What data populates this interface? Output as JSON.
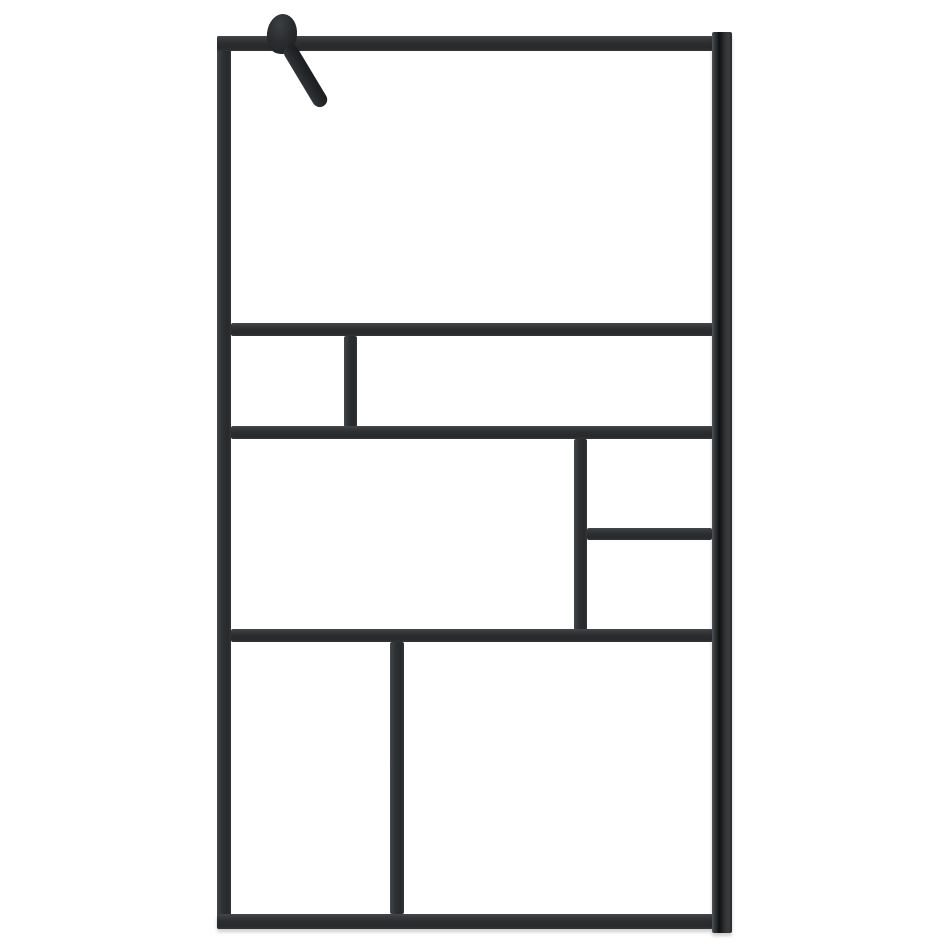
{
  "scene": {
    "description": "Product photo of a walk-in shower screen: clear glass panel in a matte black aluminium frame with an asymmetric Mondrian-style grid of muntin bars, a black wall profile on the right edge and a black wall-mount knob with an angled stabiliser support arm at the top left. Plain white background, no text.",
    "background_color": "#ffffff",
    "frame_color": "#2c2e30",
    "frame_highlight_color": "#45484a",
    "hardware_color": "#202224",
    "glass_color": "#ffffff"
  },
  "frame": {
    "canvas": {
      "width": 947,
      "height": 947
    },
    "bars": [
      {
        "name": "left-stile",
        "x": 217,
        "y": 36,
        "w": 14,
        "h": 893,
        "shadow": false
      },
      {
        "name": "top-rail",
        "x": 217,
        "y": 36,
        "w": 496,
        "h": 15,
        "shadow": false
      },
      {
        "name": "bottom-rail",
        "x": 217,
        "y": 914,
        "w": 496,
        "h": 15,
        "shadow": true
      },
      {
        "name": "divider-h-upper",
        "x": 231,
        "y": 323,
        "w": 482,
        "h": 13,
        "shadow": false
      },
      {
        "name": "divider-v-row2",
        "x": 344,
        "y": 336,
        "w": 13,
        "h": 91,
        "shadow": false
      },
      {
        "name": "divider-h-middle",
        "x": 231,
        "y": 426,
        "w": 482,
        "h": 13,
        "shadow": false
      },
      {
        "name": "divider-v-row3",
        "x": 574,
        "y": 439,
        "w": 13,
        "h": 191,
        "shadow": false
      },
      {
        "name": "divider-h-right-col",
        "x": 587,
        "y": 528,
        "w": 125,
        "h": 12,
        "shadow": false
      },
      {
        "name": "divider-h-lower",
        "x": 231,
        "y": 629,
        "w": 482,
        "h": 13,
        "shadow": false
      },
      {
        "name": "divider-v-row4",
        "x": 390,
        "y": 642,
        "w": 14,
        "h": 272,
        "shadow": false
      }
    ],
    "wall_profile": {
      "x": 712,
      "y": 32,
      "w": 20,
      "h": 901
    },
    "bracket": {
      "knob": {
        "x": 267,
        "y": 14,
        "w": 30,
        "h": 40
      },
      "arm": {
        "x": 280,
        "y": 46,
        "w": 15,
        "h": 70,
        "angle_deg": -31
      }
    }
  }
}
